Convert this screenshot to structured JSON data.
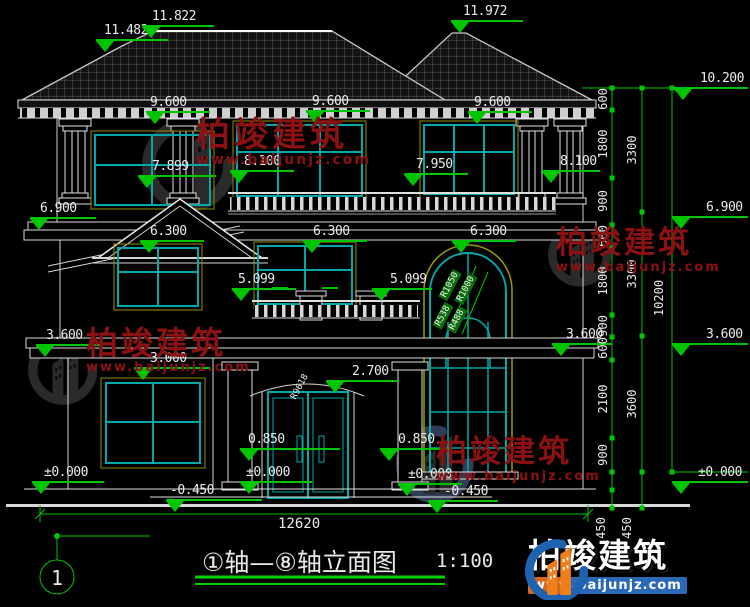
{
  "title": {
    "name": "①轴—⑧轴立面图",
    "scale": "1:100",
    "axis": "1"
  },
  "watermark": {
    "brand": "柏竣建筑",
    "url": "www.baijunjz.com"
  },
  "labels": {
    "roof_minor": "11.482",
    "roof_main": "11.822",
    "roof_right": "11.972",
    "eave_left": "9.600",
    "eave_mid": "9.600",
    "eave_right": "9.600",
    "f2_window_left": "7.899",
    "f2_balcony_left": "8.100",
    "f2_window_mid": "7.950",
    "f2_balcony_right": "8.100",
    "floor2_left": "6.900",
    "floor2_right": "6.900",
    "roof_right_eave": "10.200",
    "f3_window_left": "6.300",
    "f3_window_mid": "6.300",
    "f3_window_right": "6.300",
    "f3_sill_left": "5.099",
    "f3_sill_right": "5.099",
    "floor1_left": "3.600",
    "floor1_inner_right": "3.600",
    "floor1_right": "3.600",
    "f1_window_top": "3.000",
    "f1_door_top": "2.700",
    "f1_sill_left": "0.850",
    "f1_sill_right": "0.850",
    "ground_left": "±0.000",
    "ground_door_left": "±0.000",
    "ground_door_right": "±0.000",
    "ground_right": "±0.000",
    "step_left": "-0.450",
    "step_right": "-0.450"
  },
  "dims": {
    "total_width": "12620",
    "total_height": "10200",
    "floors": [
      "3300",
      "3300",
      "3600"
    ],
    "segments": [
      "600",
      "1800",
      "900",
      "600",
      "1800",
      "900",
      "600",
      "2100",
      "900"
    ],
    "plinth": [
      "450",
      "450"
    ]
  },
  "radii": {
    "arch_outer_left": "R1050",
    "arch_outer_right": "R1000",
    "arch_inner_left": "R538",
    "arch_inner_right": "R488",
    "door_arc": "R9618"
  },
  "colors": {
    "background": "#000000",
    "line": "#d6d6d6",
    "window_frame": "#00a8a8",
    "outer_frame": "#9a9a00",
    "dimension": "#00c500",
    "watermark_red": "#8c1113",
    "logo_blue": "#1e63b0",
    "logo_orange": "#ef7f1a"
  }
}
